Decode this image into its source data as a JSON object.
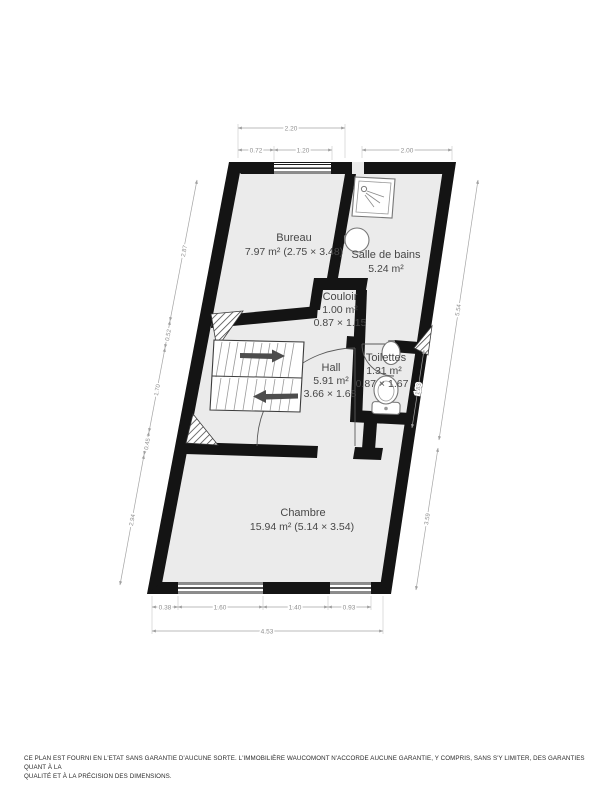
{
  "plan": {
    "title": "floor-plan",
    "rooms": [
      {
        "name": "Bureau",
        "line2": "7.97 m² (2.75 × 3.48)",
        "line3": ""
      },
      {
        "name": "Salle de bains",
        "line2": "5.24 m²",
        "line3": ""
      },
      {
        "name": "Couloir",
        "line2": "1.00 m²",
        "line3": "0.87 × 1.15"
      },
      {
        "name": "Hall",
        "line2": "5.91 m²",
        "line3": "3.66 × 1.68"
      },
      {
        "name": "Toilettes",
        "line2": "1.31 m²",
        "line3": "0.87 × 1.67"
      },
      {
        "name": "Chambre",
        "line2": "15.94 m² (5.14 × 3.54)",
        "line3": ""
      }
    ],
    "dimensions": {
      "top_total": "2.20",
      "top_wall": "0.72",
      "top_window": "1.20",
      "top_bath": "2.00",
      "left": [
        "2.87",
        "0.52",
        "1.70",
        "0.45",
        "2.94"
      ],
      "right": [
        "5.54",
        "1.83",
        "3.59"
      ],
      "bottom": [
        "0.38",
        "1.60",
        "1.40",
        "0.93"
      ],
      "bottom_total": "4.53"
    },
    "icons": [
      "shower-icon",
      "sink-icon",
      "toilet-icon",
      "stairs",
      "door-arc"
    ],
    "colors": {
      "wall": "#141414",
      "floor": "#ebebeb",
      "dim": "#8f8f8f",
      "label": "#474747",
      "arrow": "#4d4d4d"
    }
  },
  "footer": {
    "line1": "CE PLAN EST FOURNI EN L'ETAT SANS GARANTIE D'AUCUNE SORTE. L'IMMOBILIÈRE WAUCOMONT N'ACCORDE AUCUNE GARANTIE, Y COMPRIS, SANS S'Y LIMITER, DES GARANTIES QUANT À LA",
    "line2": "QUALITÉ ET À LA PRÉCISION DES DIMENSIONS."
  }
}
